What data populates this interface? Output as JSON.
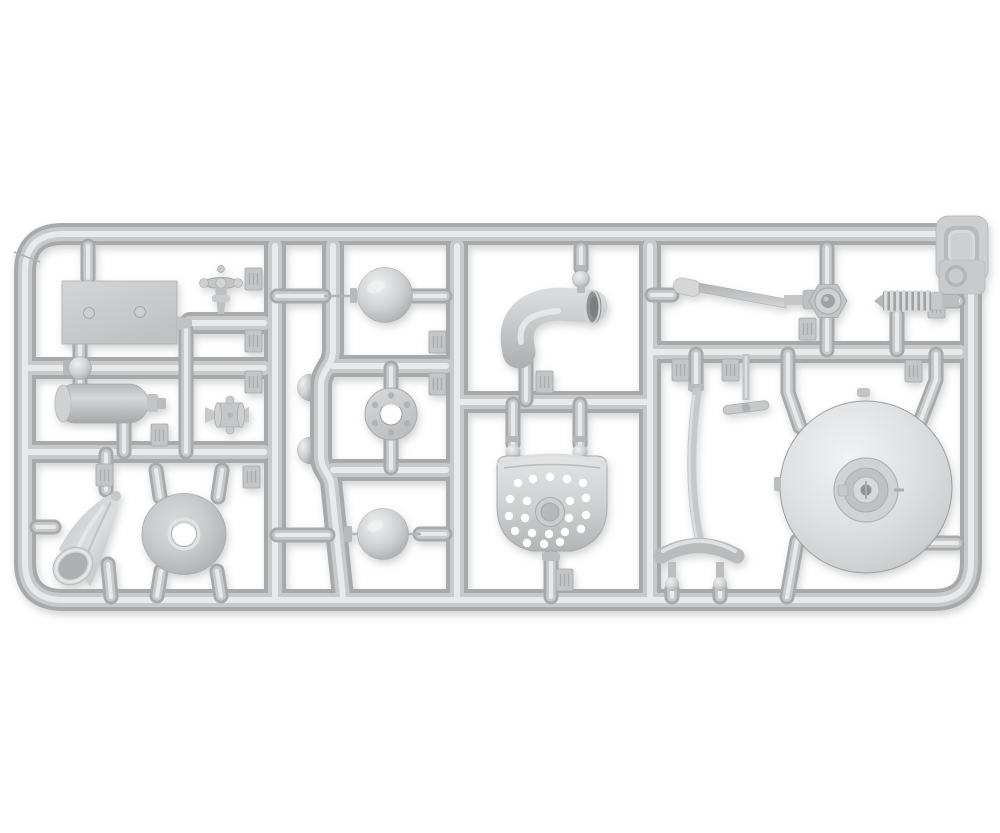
{
  "image": {
    "type": "photograph",
    "subject": "gray injection-molded plastic model kit sprue (parts tree) on a white background",
    "layout": "horizontal rounded-rectangle runner frame with internal runners dividing compartments of parts"
  },
  "palette": {
    "background": "#ffffff",
    "plastic_dark": "#a7a9ab",
    "plastic_base": "#c7c9cb",
    "plastic_light": "#e8e9ea",
    "plastic_deep": "#8f9193",
    "sphere_highlight": "#eff0f1",
    "sphere_mid": "#ced0d2",
    "sphere_shadow": "#a4a6a8",
    "disc_highlight": "#f1f2f3",
    "disc_mid": "#cdcfd1",
    "disc_edge": "#a7a9ab",
    "tag_face": "#c3c5c7",
    "hole": "#ffffff"
  },
  "sprue": {
    "frame": "rounded rectangular outer runner frame with angled corner seam at top left",
    "part_number_tags": {
      "count": 15,
      "legibility": "small embossed tabs, digits not legible"
    },
    "parts": [
      {
        "name": "rectangular-mounting-plate",
        "location": "top left",
        "detail": "flat plate with two rivet heads"
      },
      {
        "name": "globe-valve-with-handwheel",
        "location": "top left",
        "detail": "upright valve, spoked handwheel seen edge-on"
      },
      {
        "name": "inline-flanged-valve",
        "location": "left middle",
        "detail": "valve body between two cone-tipped runners"
      },
      {
        "name": "ball-pipe-fitting",
        "location": "left, on horizontal runner",
        "detail": "small spherical tee fitting"
      },
      {
        "name": "cylindrical-tank-muffler",
        "location": "left",
        "detail": "cylinder with rim and stepped nozzle"
      },
      {
        "name": "tilted-funnel-bucket",
        "location": "bottom left",
        "detail": "cone with open round mouth facing lower left"
      },
      {
        "name": "cone-funnel-disc",
        "location": "bottom left",
        "detail": "shallow cone seen from above with center hole"
      },
      {
        "name": "hemisphere-caps",
        "location": "center left on s-curved runner",
        "detail": "two half-dome caps"
      },
      {
        "name": "float-sphere-upper",
        "location": "upper center",
        "detail": "full sphere between runner gates"
      },
      {
        "name": "float-sphere-lower",
        "location": "lower center",
        "detail": "full sphere between runner gates"
      },
      {
        "name": "bolted-pipe-flange-ring",
        "location": "center",
        "detail": "ring with six bolt holes"
      },
      {
        "name": "exhaust-elbow-pipe",
        "location": "upper center",
        "detail": "thick curved elbow with open right end"
      },
      {
        "name": "small-ball-joint",
        "location": "above elbow",
        "detail": "ball on short stub"
      },
      {
        "name": "perforated-scoop-colander",
        "location": "lower center",
        "detail": "rounded pan with ~21 holes and center boss"
      },
      {
        "name": "crank-linkage-arm",
        "location": "upper right",
        "detail": "flat blade arm ending in ring with nut"
      },
      {
        "name": "coil-spring",
        "location": "upper right",
        "detail": "helical spring with cone tip"
      },
      {
        "name": "t-handle-key",
        "location": "right middle",
        "detail": "stem with flat tee bar"
      },
      {
        "name": "hanger-strap-with-saddle",
        "location": "lower center right",
        "detail": "long strap joining arched saddle with two ball feet"
      },
      {
        "name": "domed-tank-end-disc",
        "location": "right",
        "detail": "large domed disc with concentric hub and latch details"
      },
      {
        "name": "corner-lamp-housing",
        "location": "top right corner",
        "detail": "box with D-shaped and round recesses molded at frame corner"
      }
    ]
  }
}
